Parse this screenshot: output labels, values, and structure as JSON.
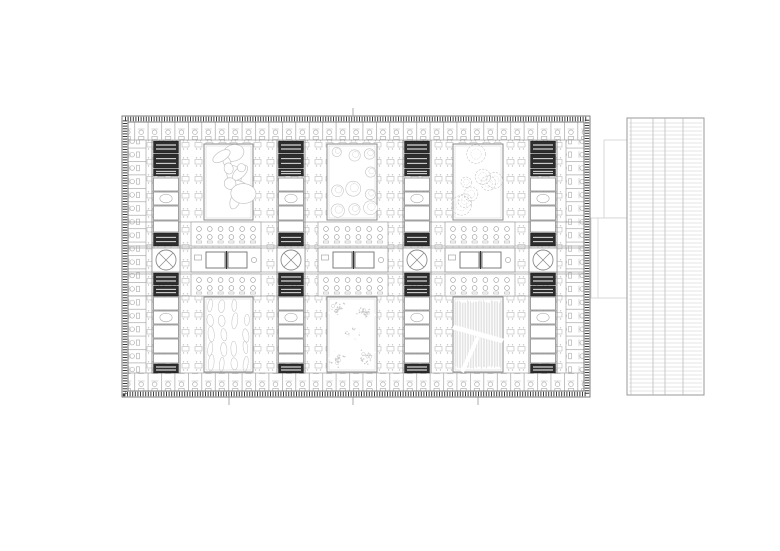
{
  "document": {
    "type": "architectural-floor-plan",
    "description": "black and white floor plan of a large rectangular building with six landscaped courtyards, four service cores, perimeter office modules and a detached linear wing on the right"
  },
  "drawing": {
    "canvas": {
      "w": 780,
      "h": 551,
      "background": "#ffffff"
    },
    "colors": {
      "wall": "#8a8a8a",
      "wall_light": "#a5a5a5",
      "dark": "#2d2d2d",
      "furniture": "#b7b7b7",
      "furniture_dot": "#c2c2c2",
      "veg": "#c5c5c5",
      "veg_light": "#d4d4d4",
      "border_dark": "#3c3c3c",
      "border_line": "#707070",
      "table": "#6f6f6f",
      "room_line": "#979797",
      "strip_line": "#cccccc",
      "strip_border": "#9a9a9a",
      "faint": "#d0d0d0",
      "white": "#ffffff"
    },
    "plan": {
      "x": 122,
      "y": 116,
      "w": 468,
      "h": 281,
      "border_inset": 6
    },
    "interior": {
      "x": 146,
      "y": 140,
      "w": 420,
      "h": 233
    },
    "bands": {
      "top": {
        "x": 128,
        "y": 122,
        "w": 456,
        "h": 18
      },
      "bottom": {
        "x": 128,
        "y": 373,
        "w": 456,
        "h": 18
      },
      "left": {
        "x": 128,
        "y": 140,
        "w": 18,
        "h": 233
      },
      "right": {
        "x": 566,
        "y": 140,
        "w": 18,
        "h": 233
      }
    },
    "h_lines": [
      140,
      222,
      246,
      248,
      272,
      274,
      296,
      373
    ],
    "v_lines": [
      146,
      152,
      180,
      277,
      305,
      403,
      431,
      529,
      557,
      566
    ],
    "courtyards": [
      {
        "id": "courtyard-1",
        "x": 204,
        "y": 144,
        "w": 49,
        "h": 76,
        "fill": "blobs",
        "seed": 11
      },
      {
        "id": "courtyard-2",
        "x": 327,
        "y": 144,
        "w": 50,
        "h": 76,
        "fill": "trees",
        "seed": 23
      },
      {
        "id": "courtyard-3",
        "x": 453,
        "y": 144,
        "w": 50,
        "h": 76,
        "fill": "scribble",
        "seed": 37
      },
      {
        "id": "courtyard-4",
        "x": 204,
        "y": 297,
        "w": 49,
        "h": 75,
        "fill": "leaves",
        "seed": 51
      },
      {
        "id": "courtyard-5",
        "x": 327,
        "y": 297,
        "w": 50,
        "h": 75,
        "fill": "groves",
        "seed": 67
      },
      {
        "id": "courtyard-6",
        "x": 453,
        "y": 297,
        "w": 50,
        "h": 75,
        "fill": "grass",
        "seed": 83
      }
    ],
    "cores": {
      "centers": [
        166,
        291,
        417,
        543
      ],
      "width": 28,
      "segments": [
        {
          "y": 141,
          "h": 12,
          "kind": "dark"
        },
        {
          "y": 154,
          "h": 14,
          "kind": "dark"
        },
        {
          "y": 169,
          "h": 7,
          "kind": "dark"
        },
        {
          "y": 178,
          "h": 13,
          "kind": "light"
        },
        {
          "y": 192,
          "h": 13,
          "kind": "lightE"
        },
        {
          "y": 206,
          "h": 14,
          "kind": "light"
        },
        {
          "y": 221,
          "h": 11,
          "kind": "light"
        },
        {
          "y": 233,
          "h": 13,
          "kind": "dark"
        },
        {
          "y": 248,
          "h": 24,
          "kind": "circle"
        },
        {
          "y": 273,
          "h": 12,
          "kind": "dark"
        },
        {
          "y": 286,
          "h": 10,
          "kind": "dark"
        },
        {
          "y": 297,
          "h": 13,
          "kind": "light"
        },
        {
          "y": 311,
          "h": 13,
          "kind": "lightE"
        },
        {
          "y": 325,
          "h": 13,
          "kind": "light"
        },
        {
          "y": 339,
          "h": 14,
          "kind": "light"
        },
        {
          "y": 354,
          "h": 9,
          "kind": "light"
        },
        {
          "y": 364,
          "h": 9,
          "kind": "dark"
        }
      ],
      "circle_r": 10
    },
    "mid_band": {
      "y": 248,
      "h": 24,
      "bays": [
        191,
        318,
        445
      ],
      "bay_w": 70
    },
    "table_rows": [
      {
        "y": 222,
        "h": 24,
        "cy1": 229,
        "cy2": 237,
        "base_y": 241
      },
      {
        "y": 274,
        "h": 22,
        "cy1": 280,
        "cy2": 288,
        "base_y": 292
      }
    ],
    "ticks": {
      "top_x": [
        353
      ],
      "top_y1": 108,
      "top_y2": 116,
      "bottom_x": [
        229,
        353,
        478
      ],
      "bottom_y1": 397,
      "bottom_y2": 405
    },
    "connector": {
      "rects": [
        [
          604,
          140,
          24,
          78
        ],
        [
          591,
          218,
          37,
          80
        ]
      ],
      "divider": {
        "x": 598,
        "y1": 218,
        "y2": 298
      }
    },
    "side_strip": {
      "x": 627,
      "y": 118,
      "w": 77,
      "h": 277,
      "inner_left": 631,
      "v_lines": [
        653,
        665,
        683
      ],
      "rung_step": 4,
      "rung_pad": 5
    }
  }
}
